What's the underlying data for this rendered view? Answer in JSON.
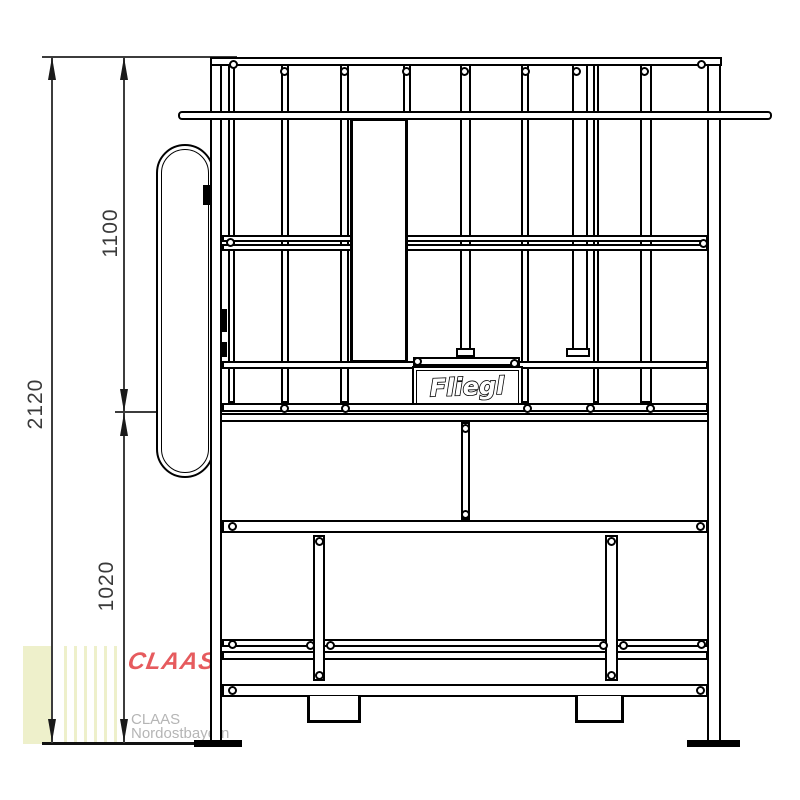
{
  "drawing": {
    "title": "Fliegl frame front-view technical drawing",
    "brand_plate": {
      "text": "Fliegl"
    },
    "dimensions": {
      "total_height": "2120",
      "upper_height": "1100",
      "lower_height": "1020"
    },
    "watermark": {
      "logo_text": "CLAAS",
      "dealer_line1": "CLAAS",
      "dealer_line2": "Nordostbayern"
    }
  },
  "colors": {
    "line": "#000000",
    "dimension": "#3c3c3c",
    "watermark_red": "#e65b5e",
    "watermark_gray": "#b5b5b5",
    "watermark_block": "#eef0cb"
  }
}
